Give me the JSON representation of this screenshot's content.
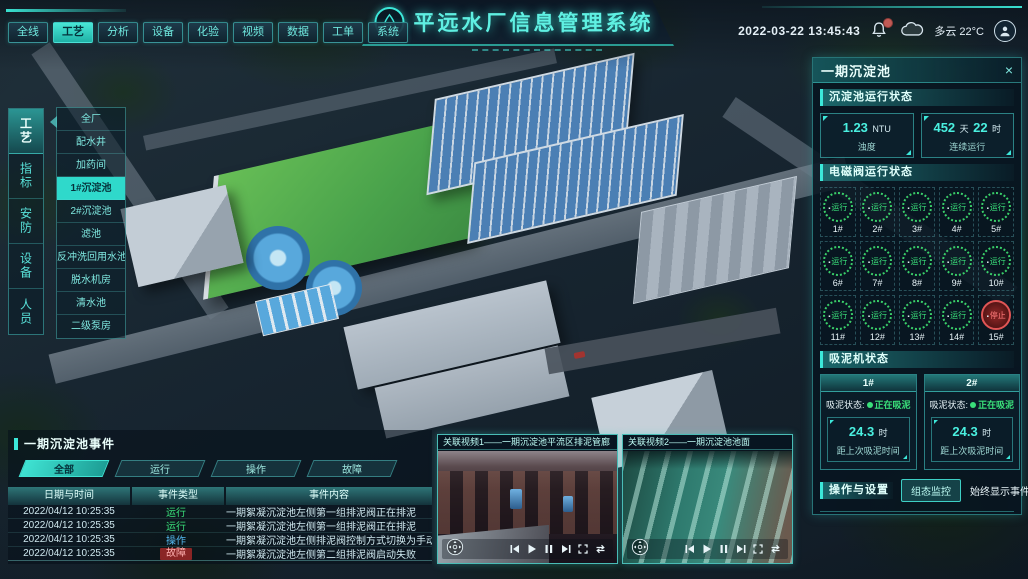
{
  "header": {
    "nav_tabs": [
      "全线",
      "工艺",
      "分析",
      "设备",
      "化验",
      "视频",
      "数据",
      "工单",
      "系统"
    ],
    "active_tab": "工艺",
    "title": "平远水厂信息管理系统",
    "datetime": "2022-03-22 13:45:43",
    "weather": "多云 22°C"
  },
  "left_nav": {
    "tabs": [
      "工艺",
      "指标",
      "安防",
      "设备",
      "人员"
    ],
    "active_tab": "工艺",
    "submenu": [
      "全厂",
      "配水井",
      "加药间",
      "1#沉淀池",
      "2#沉淀池",
      "滤池",
      "反冲洗回用水池",
      "脱水机房",
      "清水池",
      "二级泵房"
    ],
    "active_submenu": "1#沉淀池"
  },
  "right_panel": {
    "title": "一期沉淀池",
    "close": "×",
    "run_status": {
      "title": "沉淀池运行状态",
      "turbidity": {
        "value": "1.23",
        "unit": "NTU",
        "label": "浊度"
      },
      "uptime": {
        "value1": "452",
        "unit1": "天",
        "value2": "22",
        "unit2": "时",
        "label": "连续运行"
      }
    },
    "valves": {
      "title": "电磁阀运行状态",
      "items": [
        {
          "id": "1#",
          "status": "运行",
          "state": "run"
        },
        {
          "id": "2#",
          "status": "运行",
          "state": "run"
        },
        {
          "id": "3#",
          "status": "运行",
          "state": "run"
        },
        {
          "id": "4#",
          "status": "运行",
          "state": "run"
        },
        {
          "id": "5#",
          "status": "运行",
          "state": "run"
        },
        {
          "id": "6#",
          "status": "运行",
          "state": "run"
        },
        {
          "id": "7#",
          "status": "运行",
          "state": "run"
        },
        {
          "id": "8#",
          "status": "运行",
          "state": "run"
        },
        {
          "id": "9#",
          "status": "运行",
          "state": "run"
        },
        {
          "id": "10#",
          "status": "运行",
          "state": "run"
        },
        {
          "id": "11#",
          "status": "运行",
          "state": "run"
        },
        {
          "id": "12#",
          "status": "运行",
          "state": "run"
        },
        {
          "id": "13#",
          "status": "运行",
          "state": "run"
        },
        {
          "id": "14#",
          "status": "运行",
          "state": "run"
        },
        {
          "id": "15#",
          "status": "停止",
          "state": "stop"
        }
      ]
    },
    "mud_machines": {
      "title": "吸泥机状态",
      "cards": [
        {
          "id": "1#",
          "status_label": "吸泥状态:",
          "status": "正在吸泥",
          "value": "24.3",
          "unit": "时",
          "label": "距上次吸泥时间"
        },
        {
          "id": "2#",
          "status_label": "吸泥状态:",
          "status": "正在吸泥",
          "value": "24.3",
          "unit": "时",
          "label": "距上次吸泥时间"
        }
      ]
    },
    "operations": {
      "title": "操作与设置",
      "button": "组态监控",
      "toggle_label": "始终显示事件:",
      "toggle_state": "on"
    }
  },
  "events": {
    "title": "一期沉淀池事件",
    "tabs": [
      "全部",
      "运行",
      "操作",
      "故障"
    ],
    "active_tab": "全部",
    "columns": [
      "日期与时间",
      "事件类型",
      "事件内容"
    ],
    "rows": [
      {
        "time": "2022/04/12 10:25:35",
        "type": "运行",
        "type_class": "run",
        "content": "一期絮凝沉淀池左侧第一组排泥阀正在排泥"
      },
      {
        "time": "2022/04/12 10:25:35",
        "type": "运行",
        "type_class": "run",
        "content": "一期絮凝沉淀池左侧第一组排泥阀正在排泥"
      },
      {
        "time": "2022/04/12 10:25:35",
        "type": "操作",
        "type_class": "op",
        "content": "一期絮凝沉淀池左侧排泥阀控制方式切换为手动"
      },
      {
        "time": "2022/04/12 10:25:35",
        "type": "故障",
        "type_class": "fault",
        "content": "一期絮凝沉淀池左侧第二组排泥阀启动失败"
      }
    ]
  },
  "videos": [
    {
      "title": "关联视频1——一期沉淀池平流区排泥管廊"
    },
    {
      "title": "关联视频2——一期沉淀池池面"
    }
  ],
  "colors": {
    "accent": "#35e0d0",
    "run_green": "#3ae07a",
    "op_blue": "#55b8f0",
    "fault_red": "#e05555"
  }
}
